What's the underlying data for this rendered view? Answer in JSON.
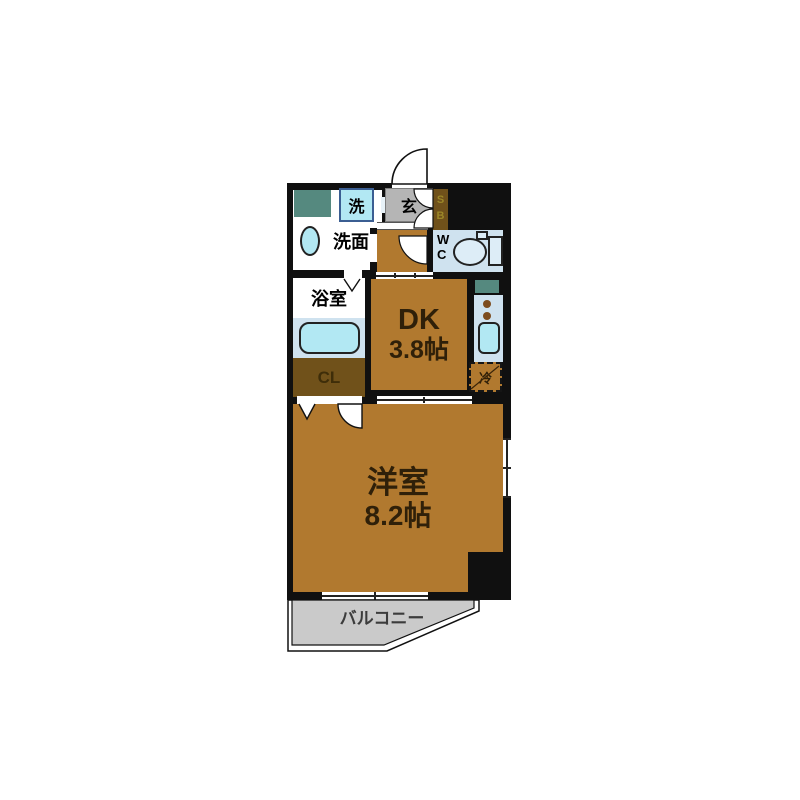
{
  "floorplan": {
    "title": "1DK apartment floor plan",
    "rooms": {
      "entrance": {
        "label": "玄"
      },
      "shoe_box": {
        "letters": [
          "S",
          "B"
        ]
      },
      "wc": {
        "letters": [
          "W",
          "C"
        ]
      },
      "laundry": {
        "label": "洗"
      },
      "washroom": {
        "label": "洗面"
      },
      "bathroom": {
        "label": "浴室"
      },
      "closet": {
        "label": "CL"
      },
      "dk": {
        "label": "DK",
        "size": "3.8帖"
      },
      "living": {
        "label": "洋室",
        "size": "8.2帖"
      },
      "refrigerator": {
        "label": "冷"
      },
      "balcony": {
        "label": "バルコニー"
      }
    },
    "colors": {
      "wall": "#101010",
      "brown": "#b1792f",
      "dark_brown": "#70511a",
      "tile": "#b5b5b5",
      "fixture": "#cfe2ef",
      "cyan": "#b2e8f3",
      "teal": "#55897f",
      "balcony": "#cacaca",
      "label": "#2f2009",
      "sb_text": "#9c8728",
      "balcony_text": "#3c3c3c"
    }
  }
}
